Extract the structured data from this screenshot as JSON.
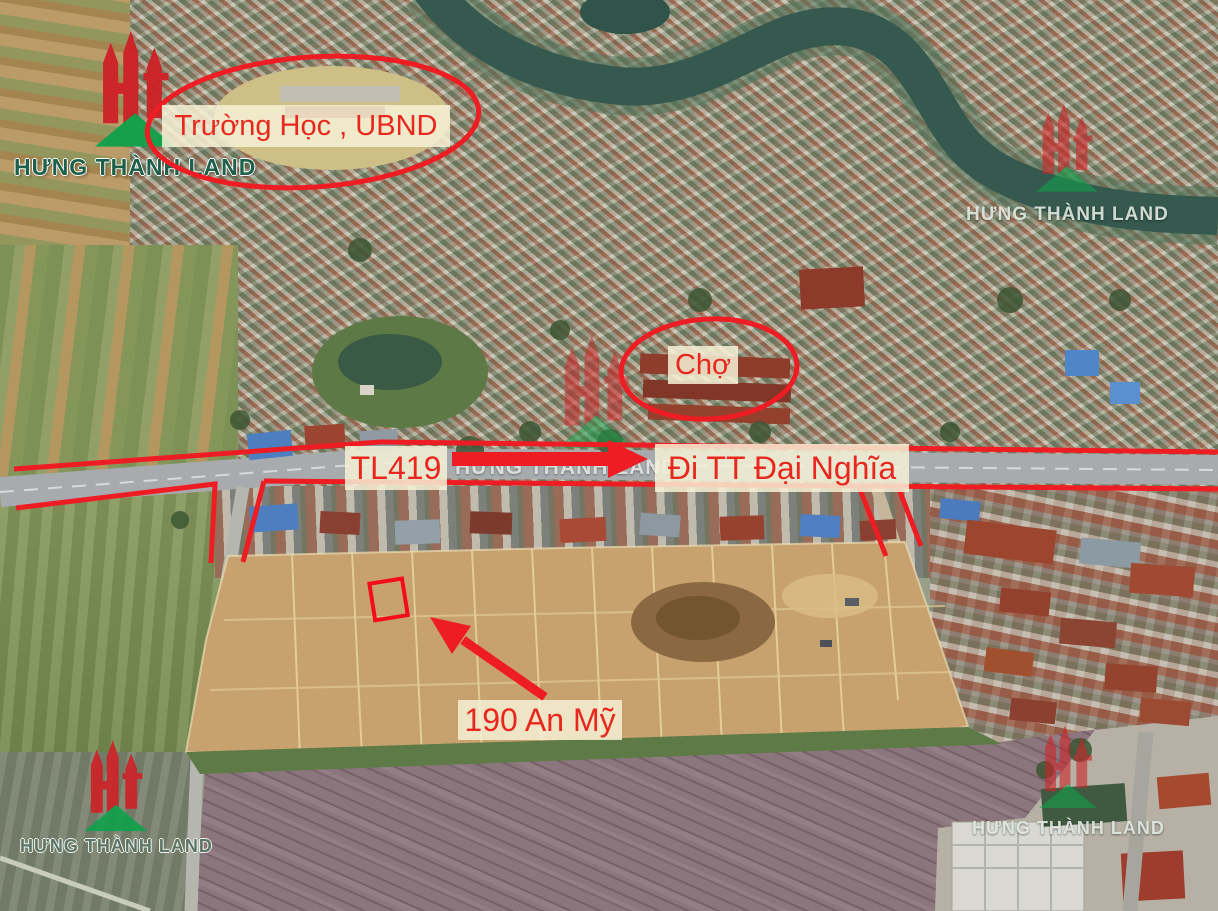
{
  "watermark": {
    "brand": "HƯNG THÀNH LAND"
  },
  "map": {
    "labels": {
      "school": "Trường Học , UBND",
      "market": "Chợ",
      "road": "TL419",
      "direction": "Đi TT Đại Nghĩa",
      "address": "190 An Mỹ"
    }
  },
  "colors": {
    "annotation_red": "#ee1d24",
    "label_background": "#f6f1d6",
    "label_text": "#e8281e",
    "logo_red": "#cd2328",
    "logo_green": "#12a14b"
  }
}
